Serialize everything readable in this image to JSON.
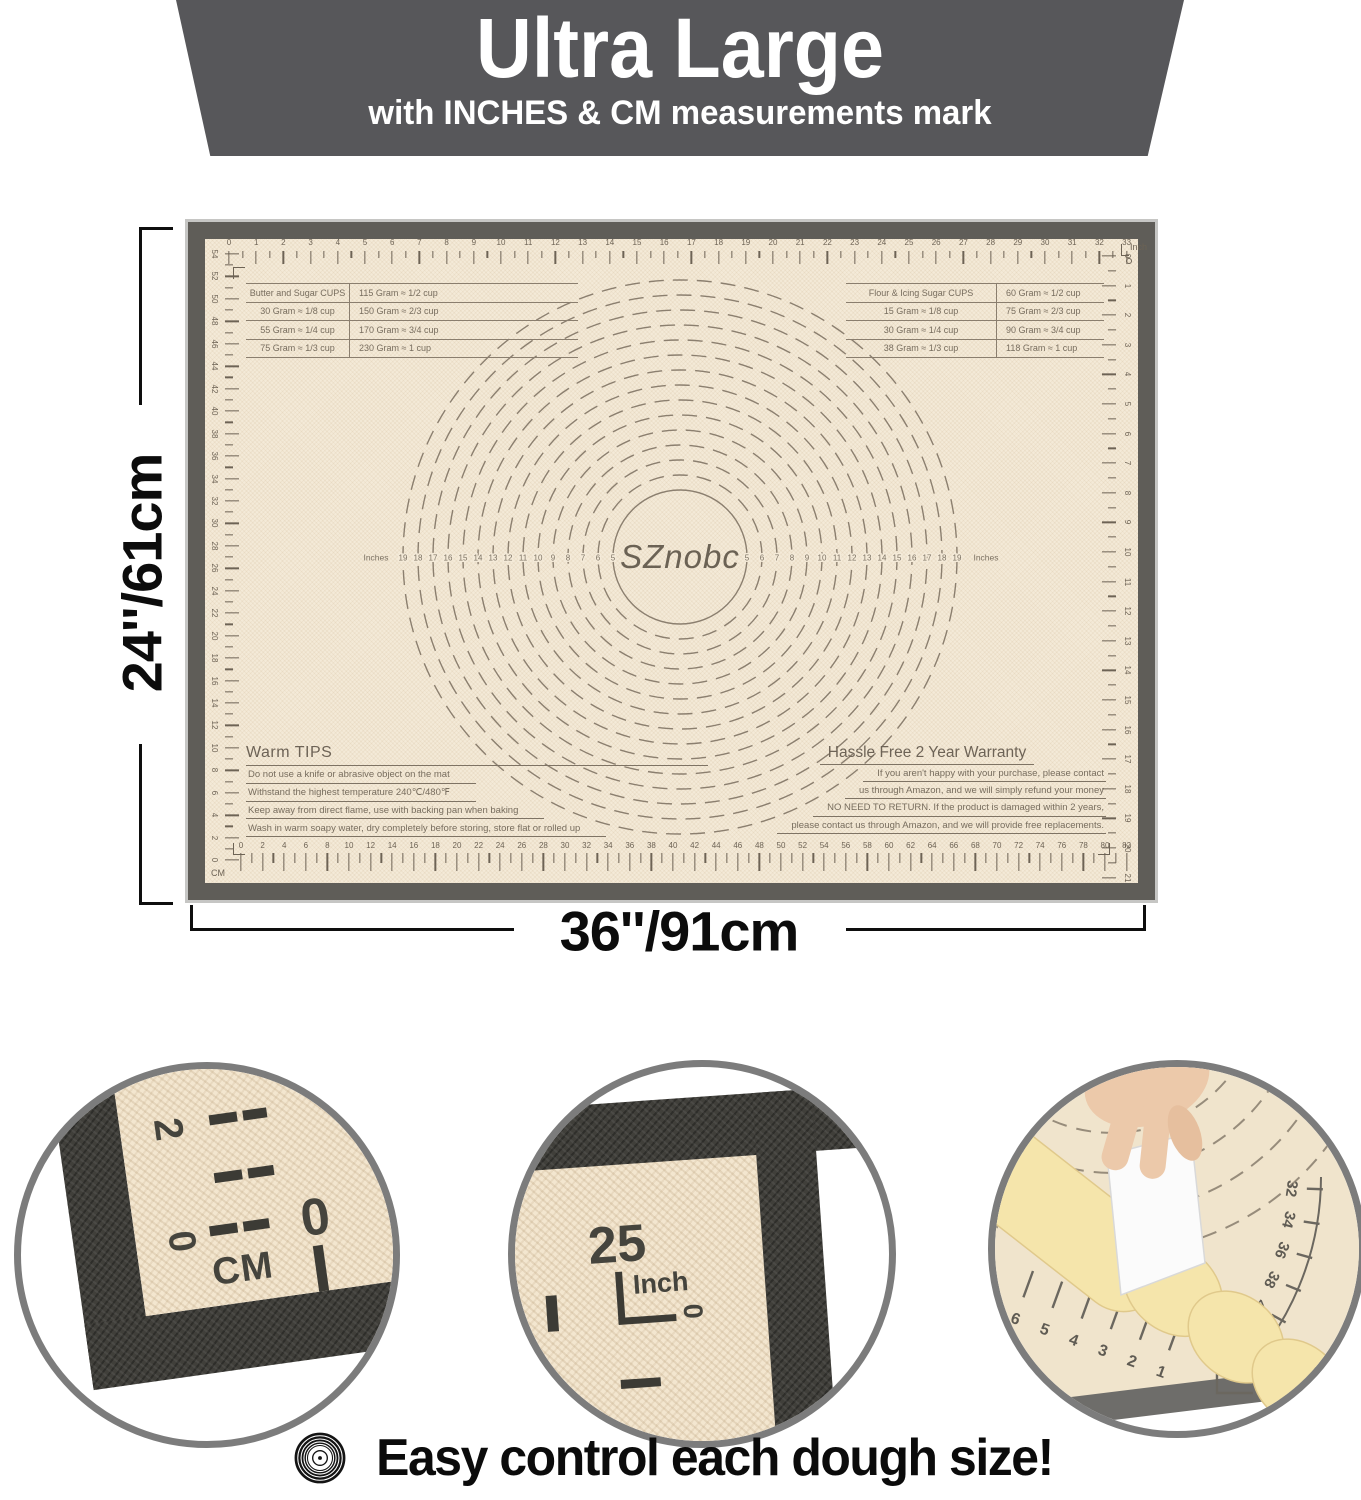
{
  "banner": {
    "title": "Ultra Large",
    "subtitle": "with INCHES & CM measurements mark"
  },
  "dimensions": {
    "height_label": "24''/61cm",
    "width_label": "36''/91cm"
  },
  "mat": {
    "brand": "SZnobc",
    "center_unit_word": "Inches",
    "rulers": {
      "top": {
        "unit": "Inch",
        "numbers": [
          0,
          1,
          2,
          3,
          4,
          5,
          6,
          7,
          8,
          9,
          10,
          11,
          12,
          13,
          14,
          15,
          16,
          17,
          18,
          19,
          20,
          21,
          22,
          23,
          24,
          25,
          26,
          27,
          28,
          29,
          30,
          31,
          32,
          33
        ]
      },
      "bottom": {
        "unit": "CM",
        "numbers": [
          0,
          2,
          4,
          6,
          8,
          10,
          12,
          14,
          16,
          18,
          20,
          22,
          24,
          26,
          28,
          30,
          32,
          34,
          36,
          38,
          40,
          42,
          44,
          46,
          48,
          50,
          52,
          54,
          56,
          58,
          60,
          62,
          64,
          66,
          68,
          70,
          72,
          74,
          76,
          78,
          80,
          82
        ]
      },
      "left": {
        "unit": "CM",
        "numbers": [
          54,
          52,
          50,
          48,
          46,
          44,
          42,
          40,
          38,
          36,
          34,
          32,
          30,
          28,
          26,
          24,
          22,
          20,
          18,
          16,
          14,
          12,
          10,
          8,
          6,
          4,
          2,
          0
        ]
      },
      "right": {
        "unit": "Inch",
        "numbers": [
          0,
          1,
          2,
          3,
          4,
          5,
          6,
          7,
          8,
          9,
          10,
          11,
          12,
          13,
          14,
          15,
          16,
          17,
          18,
          19,
          20,
          21
        ]
      }
    },
    "circle_numbers": [
      5,
      6,
      7,
      8,
      9,
      10,
      11,
      12,
      13,
      14,
      15,
      16,
      17,
      18,
      19
    ],
    "butter_table": {
      "rows": [
        [
          "Butter and Sugar CUPS",
          "115 Gram ≈ 1/2 cup"
        ],
        [
          "30 Gram ≈ 1/8 cup",
          "150 Gram ≈ 2/3 cup"
        ],
        [
          "55 Gram ≈ 1/4 cup",
          "170 Gram ≈ 3/4 cup"
        ],
        [
          "75 Gram ≈ 1/3 cup",
          "230 Gram ≈ 1 cup"
        ]
      ]
    },
    "flour_table": {
      "rows": [
        [
          "Flour & Icing Sugar CUPS",
          "60 Gram ≈ 1/2 cup"
        ],
        [
          "15 Gram ≈ 1/8 cup",
          "75 Gram ≈ 2/3 cup"
        ],
        [
          "30 Gram ≈ 1/4 cup",
          "90 Gram ≈ 3/4 cup"
        ],
        [
          "38 Gram ≈ 1/3 cup",
          "118 Gram ≈ 1 cup"
        ]
      ]
    },
    "warm_tips": {
      "title": "Warm TIPS",
      "lines": [
        "Do not use a knife or abrasive object on the mat",
        "Withstand the highest temperature 240℃/480℉",
        "Keep away from direct flame, use with backing pan when baking",
        "Wash in warm soapy water, dry completely before storing, store flat or rolled up"
      ]
    },
    "warranty": {
      "title": "Hassle Free 2 Year Warranty",
      "lines": [
        "If you aren't happy with your purchase, please contact",
        "us through Amazon,  and we will simply refund your money",
        "NO NEED TO RETURN. If the product is damaged within 2 years,",
        "please contact us through Amazon, and we will provide free replacements."
      ]
    }
  },
  "insets": {
    "cm_corner": {
      "side_number_top": "2",
      "side_number_bottom": "0",
      "unit": "CM",
      "bottom_number": "0"
    },
    "inch_corner": {
      "number": "25",
      "unit": "Inch",
      "zero": "0"
    },
    "dough_photo": {
      "left_numbers": [
        "6",
        "5",
        "4",
        "3",
        "2",
        "1"
      ],
      "arc_numbers": [
        "32",
        "34",
        "36",
        "38",
        "40",
        "42",
        "44"
      ],
      "corner_zero": "0"
    }
  },
  "caption": {
    "text": "Easy control each dough size!"
  },
  "colors": {
    "banner_bg": "#57575a",
    "mat_border": "#5f5d58",
    "mat_surface": "#f4ead8",
    "marking": "#8b7f6f",
    "accent_text": "#0c0c0c",
    "dough": "#f5e5ab",
    "inset_ring": "#7c7c7c"
  }
}
